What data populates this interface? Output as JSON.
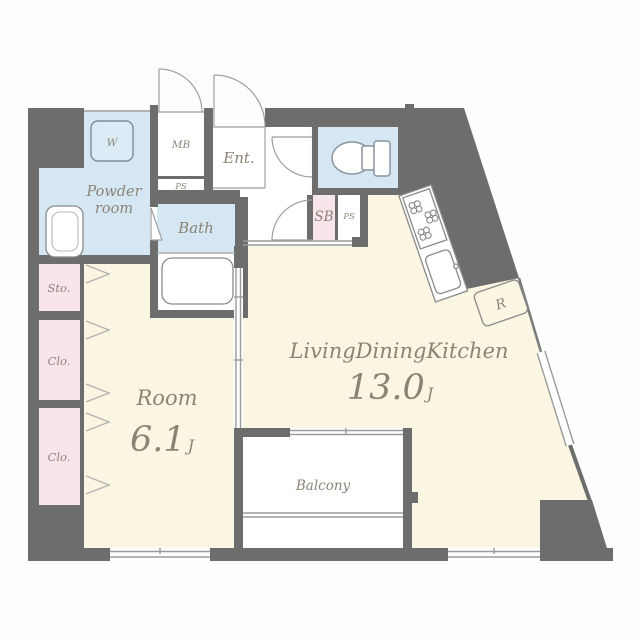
{
  "plan": {
    "rooms": {
      "powder": {
        "line1": "Powder",
        "line2": "room"
      },
      "washer": {
        "label": "W"
      },
      "meter_box": {
        "label": "MB"
      },
      "pipe_space_top": {
        "label": "PS"
      },
      "entrance": {
        "label": "Ent."
      },
      "bath": {
        "label": "Bath"
      },
      "shoe_box": {
        "label": "SB"
      },
      "pipe_space_right": {
        "label": "PS"
      },
      "storage": {
        "label": "Sto."
      },
      "closet_upper": {
        "label": "Clo."
      },
      "closet_lower": {
        "label": "Clo."
      },
      "bedroom": {
        "name": "Room",
        "size": "6.1",
        "unit": "J"
      },
      "ldk": {
        "name": "LivingDiningKitchen",
        "size": "13.0",
        "unit": "J"
      },
      "balcony": {
        "label": "Balcony"
      },
      "refrigerator": {
        "label": "R"
      }
    },
    "colors": {
      "wall": "#6d6d6d",
      "wet_room_blue": "#d5e7f2",
      "living_cream": "#faf6e2",
      "closet_pink": "#f8e5ec",
      "label_text": "#8b8476"
    }
  }
}
